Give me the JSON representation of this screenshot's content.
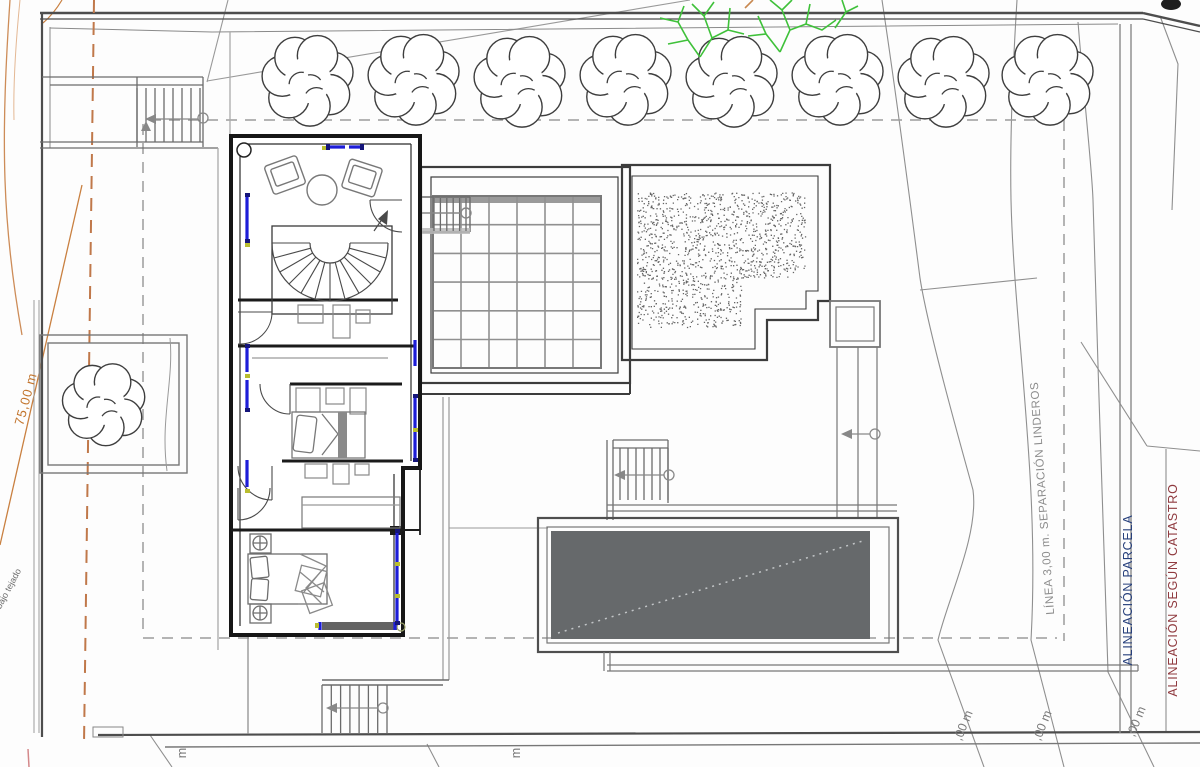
{
  "drawing": {
    "type": "architectural site / floor plan",
    "labels": {
      "dim_75m": "75,00 m",
      "bajo_tejado": "bajo tejado",
      "linea_separacion": "LÍNEA 3,00 m. SEPARACIÓN LINDEROS",
      "alineacion_parcela": "ALINEACIÓN PARCELA",
      "alineacion_catastro": "ALINEACIÓN SEGÚN CATASTRO",
      "m_label_left": "m",
      "m_label_mid": "m",
      "dim_fragment_1": ",00 m",
      "dim_fragment_2": ",00 m",
      "dim_fragment_3": ",00 m"
    },
    "colors": {
      "orange_dimension": "#c2742c",
      "orange_dashed": "#c0784a",
      "parcela_blue": "#27407c",
      "catastro_red": "#8f3a3f",
      "setback_dashed_gray": "#9c9c9c",
      "window_blue": "#1d1dd8",
      "tick_yellow": "#b9bd2f",
      "pool_gray": "#66696b",
      "tree_green": "#3fc13a",
      "line_dark": "#1b1b1b"
    }
  }
}
